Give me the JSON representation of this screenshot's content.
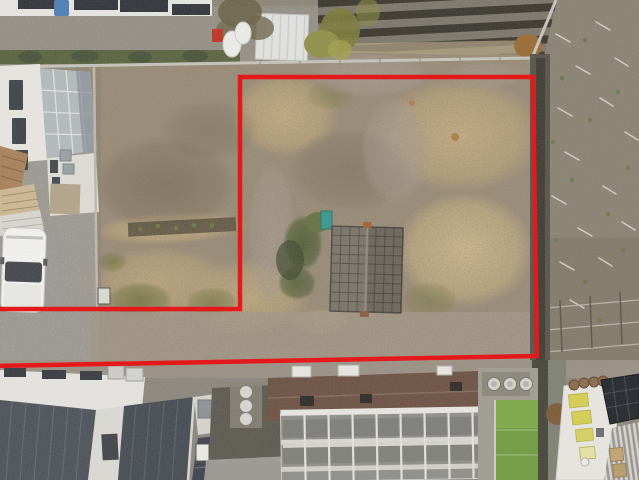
{
  "scene": {
    "title": "Aerial drone photo of a vacant overgrown land parcel outlined with a red property boundary line, surrounded by houses, a farm field, a fallow field and greenhouses",
    "type": "aerial-drone-photo",
    "boundary": {
      "color": "#e3191c",
      "stroke_width": 4.5,
      "points": "-4,309 240,309 240,77 533,77 537,356 -4,366"
    }
  },
  "palette": {
    "dirt": "#9c8d77",
    "dry_grass": "#c9b183",
    "field_right": "#8c8474",
    "farm_soil": "#7d766a",
    "farm_mulch": "#39372f",
    "hedge_green": "#5a6340",
    "roof_dark": "#4d525a",
    "roof_brown": "#6d5143",
    "turf_green": "#6f9c3f",
    "greenhouse_frame": "#e8e7e3",
    "white_building": "#e9e7e2",
    "van_white": "#f3f3f1",
    "teal_object": "#35988f"
  },
  "objects": {
    "boundary_line": "red parcel outline",
    "vacant_lot": "overgrown dirt parcel with dry grass",
    "lot_shed": "small dark tiled-roof shed inside the lot",
    "white_van": "white van parked on driveway",
    "house": "white house with glass conservatory roof",
    "storage_shed": "white storage shed with gas tanks",
    "farm_field": "dark mulched crop rows",
    "fallow_field": "gray-brown fallow field with scattered stakes",
    "greenhouse": "white-framed glass greenhouse",
    "brown_roof_building": "brown metal roof building with vents",
    "dark_seam_roofs": "dark standing-seam metal roofs",
    "turf_patch": "bright green turf strip",
    "manhole_covers": "three round covers on concrete pad"
  }
}
